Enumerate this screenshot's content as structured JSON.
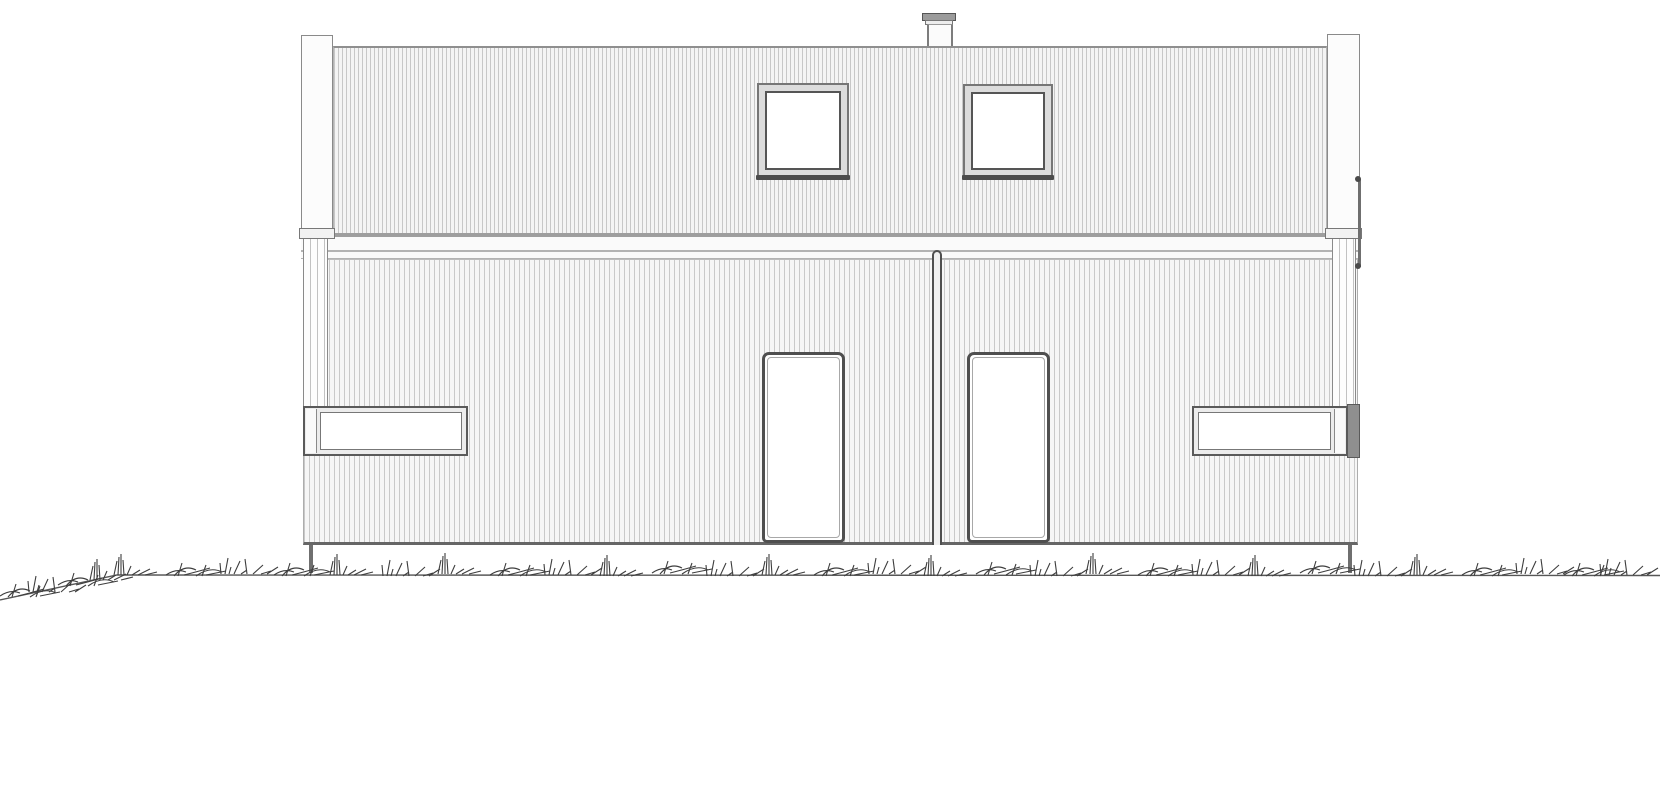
{
  "meta": {
    "title": "Architectural front elevation drawing of a duplex house with vertical cladding",
    "drawing_type": "elevation line drawing",
    "style": "black-and-white technical drawing on white background"
  },
  "palette": {
    "background": "#ffffff",
    "line_dark": "#4a4a4a",
    "line_mid": "#8a8a8a",
    "line_light": "#c7c7c7",
    "siding_fill": "#f4f4f4",
    "frame_fill": "#dcdcdc",
    "glass_fill": "#ffffff",
    "grass_stroke": "#3e3e3e"
  },
  "elements": {
    "chimney": {
      "count": 1,
      "label": "roof chimney with cap"
    },
    "roof_windows": {
      "count": 2,
      "label": "square attic window"
    },
    "doors": {
      "count": 2,
      "label": "entrance door"
    },
    "strip_windows": {
      "count": 2,
      "label": "horizontal strip window"
    },
    "corner_boards": {
      "count": 2,
      "label": "corner board with downspout"
    },
    "party_wall_joint": {
      "count": 1,
      "label": "vertical joint between dwelling units"
    },
    "trim_band": {
      "label": "horizontal trim band between attic and ground floor"
    },
    "foundation_posts": {
      "count": 2,
      "label": "foundation post"
    },
    "ground": {
      "label": "hand-drawn grass ground line sloping down at far left"
    }
  }
}
